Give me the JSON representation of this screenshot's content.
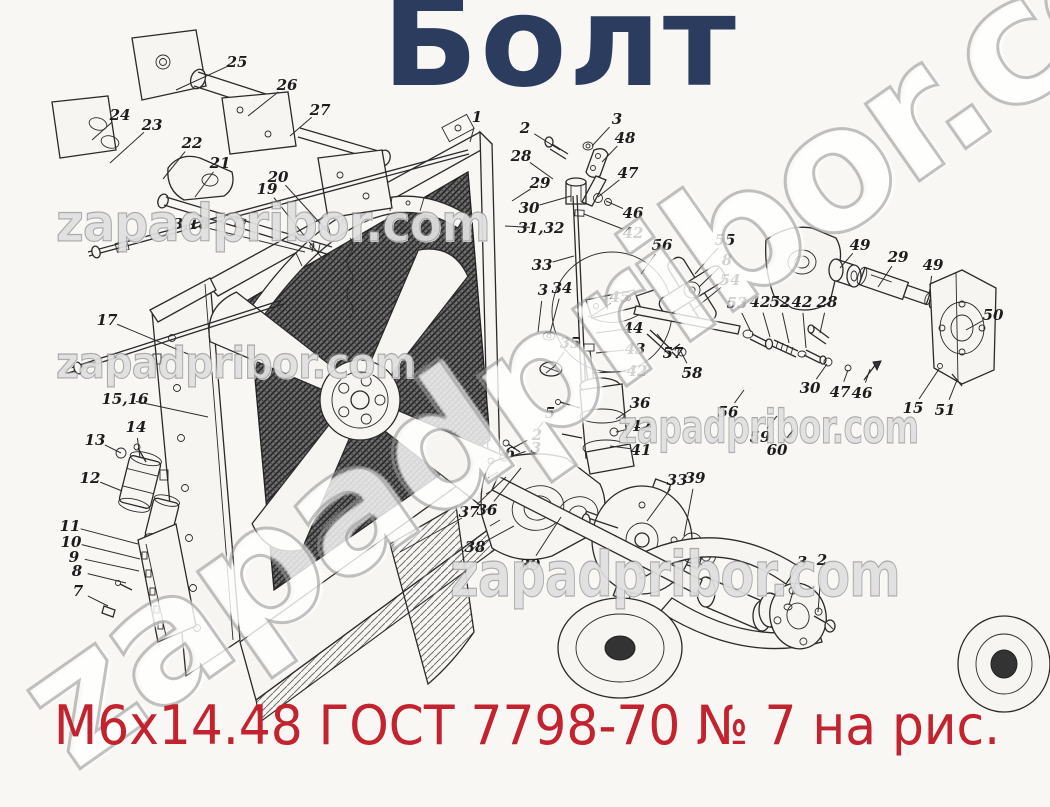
{
  "title": "Болт",
  "subtitle": "М6х14.48 ГОСТ 7798-70 № 7 на рис.",
  "colors": {
    "title": "#2c3c5f",
    "subtitle": "#c3222f",
    "ink": "#2a2a2a",
    "background": "#f8f7f4",
    "watermark": "#9a9a9a"
  },
  "watermark": {
    "text": "zapadpribor.com",
    "rows": [
      {
        "left": 56,
        "top": 194,
        "size": 52,
        "scale_x": 0.92
      },
      {
        "left": 56,
        "top": 338,
        "size": 44,
        "scale_x": 0.9
      },
      {
        "left": 618,
        "top": 400,
        "size": 46,
        "scale_x": 0.72
      },
      {
        "left": 450,
        "top": 538,
        "size": 62,
        "scale_x": 0.8
      }
    ],
    "diagonal": {
      "left": -18,
      "top": 642,
      "size": 172,
      "angle": -35
    }
  },
  "diagram": {
    "description": "Exploded parts view of tractor radiator, fan and water pump assembly with numbered callouts",
    "callouts": [
      {
        "label": "25",
        "x": 237,
        "y": 62,
        "tx": 176,
        "ty": 90
      },
      {
        "label": "26",
        "x": 287,
        "y": 85,
        "tx": 248,
        "ty": 116
      },
      {
        "label": "27",
        "x": 320,
        "y": 110,
        "tx": 290,
        "ty": 136
      },
      {
        "label": "24",
        "x": 120,
        "y": 115,
        "tx": 92,
        "ty": 140
      },
      {
        "label": "23",
        "x": 152,
        "y": 125,
        "tx": 110,
        "ty": 163
      },
      {
        "label": "22",
        "x": 192,
        "y": 143,
        "tx": 163,
        "ty": 179
      },
      {
        "label": "21",
        "x": 220,
        "y": 163,
        "tx": 195,
        "ty": 197
      },
      {
        "label": "20",
        "x": 278,
        "y": 177,
        "tx": 328,
        "ty": 232
      },
      {
        "label": "19",
        "x": 267,
        "y": 189,
        "tx": 322,
        "ty": 258
      },
      {
        "label": "3,18",
        "x": 191,
        "y": 224,
        "tx": 305,
        "ty": 252
      },
      {
        "label": "17",
        "x": 107,
        "y": 320,
        "tx": 188,
        "ty": 354
      },
      {
        "label": "15,16",
        "x": 125,
        "y": 399,
        "tx": 208,
        "ty": 417
      },
      {
        "label": "14",
        "x": 136,
        "y": 427,
        "tx": 140,
        "ty": 458
      },
      {
        "label": "13",
        "x": 95,
        "y": 440,
        "tx": 121,
        "ty": 453
      },
      {
        "label": "12",
        "x": 90,
        "y": 478,
        "tx": 122,
        "ty": 491
      },
      {
        "label": "11",
        "x": 70,
        "y": 526,
        "tx": 138,
        "ty": 544
      },
      {
        "label": "10",
        "x": 71,
        "y": 542,
        "tx": 140,
        "ty": 559
      },
      {
        "label": "9",
        "x": 74,
        "y": 557,
        "tx": 139,
        "ty": 571
      },
      {
        "label": "8",
        "x": 77,
        "y": 571,
        "tx": 126,
        "ty": 583
      },
      {
        "label": "7",
        "x": 78,
        "y": 591,
        "tx": 108,
        "ty": 606
      },
      {
        "label": "1",
        "x": 477,
        "y": 117,
        "tx": 470,
        "ty": 142
      },
      {
        "label": "2",
        "x": 525,
        "y": 128,
        "tx": 560,
        "ty": 150
      },
      {
        "label": "3",
        "x": 617,
        "y": 119,
        "tx": 592,
        "ty": 146
      },
      {
        "label": "48",
        "x": 625,
        "y": 138,
        "tx": 602,
        "ty": 162
      },
      {
        "label": "28",
        "x": 521,
        "y": 156,
        "tx": 553,
        "ty": 179
      },
      {
        "label": "29",
        "x": 540,
        "y": 183,
        "tx": 512,
        "ty": 201
      },
      {
        "label": "30",
        "x": 529,
        "y": 208,
        "tx": 571,
        "ty": 196
      },
      {
        "label": "47",
        "x": 628,
        "y": 173,
        "tx": 598,
        "ty": 197
      },
      {
        "label": "46",
        "x": 633,
        "y": 213,
        "tx": 606,
        "ty": 201
      },
      {
        "label": "31,32",
        "x": 541,
        "y": 228,
        "tx": 505,
        "ty": 226
      },
      {
        "label": "42",
        "x": 633,
        "y": 233,
        "tx": 584,
        "ty": 214
      },
      {
        "label": "33",
        "x": 542,
        "y": 265,
        "tx": 574,
        "ty": 256
      },
      {
        "label": "3",
        "x": 543,
        "y": 290,
        "tx": 538,
        "ty": 332
      },
      {
        "label": "34",
        "x": 562,
        "y": 288,
        "tx": 550,
        "ty": 333
      },
      {
        "label": "45",
        "x": 620,
        "y": 297,
        "tx": 592,
        "ty": 316
      },
      {
        "label": "44",
        "x": 633,
        "y": 328,
        "tx": 596,
        "ty": 333
      },
      {
        "label": "43",
        "x": 635,
        "y": 349,
        "tx": 596,
        "ty": 353
      },
      {
        "label": "42",
        "x": 637,
        "y": 371,
        "tx": 592,
        "ty": 373
      },
      {
        "label": "35",
        "x": 570,
        "y": 343,
        "tx": 553,
        "ty": 368
      },
      {
        "label": "5",
        "x": 550,
        "y": 413,
        "tx": 537,
        "ty": 430
      },
      {
        "label": "36",
        "x": 640,
        "y": 403,
        "tx": 616,
        "ty": 419
      },
      {
        "label": "42",
        "x": 641,
        "y": 426,
        "tx": 616,
        "ty": 432
      },
      {
        "label": "41",
        "x": 641,
        "y": 450,
        "tx": 610,
        "ty": 446
      },
      {
        "label": "2",
        "x": 537,
        "y": 435,
        "tx": 513,
        "ty": 448
      },
      {
        "label": "3",
        "x": 536,
        "y": 448,
        "tx": 509,
        "ty": 457
      },
      {
        "label": "6",
        "x": 510,
        "y": 453,
        "tx": 494,
        "ty": 462
      },
      {
        "label": "37",
        "x": 469,
        "y": 512,
        "tx": 506,
        "ty": 477
      },
      {
        "label": "36",
        "x": 487,
        "y": 510,
        "tx": 521,
        "ty": 468
      },
      {
        "label": "38",
        "x": 475,
        "y": 547,
        "tx": 514,
        "ty": 526
      },
      {
        "label": "39",
        "x": 530,
        "y": 565,
        "tx": 561,
        "ty": 517
      },
      {
        "label": "33",
        "x": 677,
        "y": 480,
        "tx": 647,
        "ty": 521
      },
      {
        "label": "39",
        "x": 695,
        "y": 478,
        "tx": 684,
        "ty": 536
      },
      {
        "label": "56",
        "x": 662,
        "y": 245,
        "tx": 641,
        "ty": 274
      },
      {
        "label": "55",
        "x": 725,
        "y": 240,
        "tx": 695,
        "ty": 274
      },
      {
        "label": "8",
        "x": 727,
        "y": 260,
        "tx": 699,
        "ty": 287
      },
      {
        "label": "54",
        "x": 730,
        "y": 280,
        "tx": 692,
        "ty": 311
      },
      {
        "label": "53",
        "x": 737,
        "y": 303,
        "tx": 751,
        "ty": 332
      },
      {
        "label": "42",
        "x": 760,
        "y": 302,
        "tx": 770,
        "ty": 337
      },
      {
        "label": "52",
        "x": 780,
        "y": 302,
        "tx": 789,
        "ty": 343
      },
      {
        "label": "42",
        "x": 802,
        "y": 302,
        "tx": 806,
        "ty": 348
      },
      {
        "label": "28",
        "x": 827,
        "y": 302,
        "tx": 820,
        "ty": 333
      },
      {
        "label": "49",
        "x": 860,
        "y": 245,
        "tx": 840,
        "ty": 268
      },
      {
        "label": "29",
        "x": 898,
        "y": 257,
        "tx": 878,
        "ty": 287
      },
      {
        "label": "49",
        "x": 933,
        "y": 265,
        "tx": 929,
        "ty": 296
      },
      {
        "label": "50",
        "x": 993,
        "y": 315,
        "tx": 966,
        "ty": 330
      },
      {
        "label": "30",
        "x": 810,
        "y": 388,
        "tx": 827,
        "ty": 364
      },
      {
        "label": "47",
        "x": 840,
        "y": 392,
        "tx": 848,
        "ty": 370
      },
      {
        "label": "46",
        "x": 862,
        "y": 393,
        "tx": 870,
        "ty": 369
      },
      {
        "label": "15",
        "x": 913,
        "y": 408,
        "tx": 939,
        "ty": 369
      },
      {
        "label": "51",
        "x": 945,
        "y": 410,
        "tx": 957,
        "ty": 380
      },
      {
        "label": "56",
        "x": 728,
        "y": 412,
        "tx": 744,
        "ty": 390
      },
      {
        "label": "59",
        "x": 760,
        "y": 437,
        "tx": 777,
        "ty": 416
      },
      {
        "label": "60",
        "x": 777,
        "y": 450,
        "tx": 794,
        "ty": 429
      },
      {
        "label": "57",
        "x": 673,
        "y": 353,
        "tx": 657,
        "ty": 334
      },
      {
        "label": "58",
        "x": 692,
        "y": 373,
        "tx": 680,
        "ty": 350
      },
      {
        "label": "3",
        "x": 802,
        "y": 562,
        "tx": 789,
        "ty": 605
      },
      {
        "label": "2",
        "x": 822,
        "y": 560,
        "tx": 818,
        "ty": 612
      }
    ]
  }
}
